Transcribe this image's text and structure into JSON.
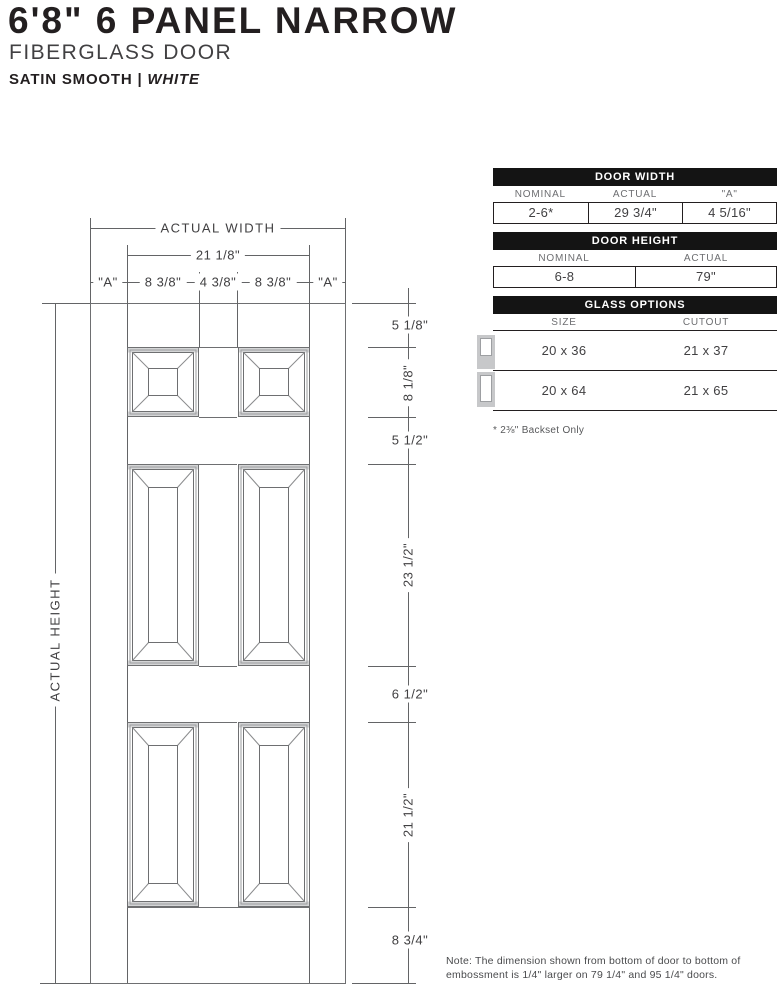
{
  "header": {
    "title": "6'8\" 6 PANEL NARROW",
    "subtitle": "FIBERGLASS DOOR",
    "finish": "SATIN SMOOTH",
    "separator": " | ",
    "color": "WHITE"
  },
  "diagram": {
    "labels": {
      "actual_width": "ACTUAL WIDTH",
      "actual_height": "ACTUAL HEIGHT",
      "inner_width": "21 1/8\"",
      "a_left": "\"A\"",
      "w_838_left": "8 3/8\"",
      "w_438": "4 3/8\"",
      "w_838_right": "8 3/8\"",
      "a_right": "\"A\"",
      "h_top_rail": "5 1/8\"",
      "h_top_panel": "8 1/8\"",
      "h_mid_rail1": "5 1/2\"",
      "h_mid_panel": "23 1/2\"",
      "h_mid_rail2": "6 1/2\"",
      "h_bottom_panel": "21 1/2\"",
      "h_bottom_rail": "8 3/4\""
    }
  },
  "tables": {
    "door_width": {
      "title": "DOOR WIDTH",
      "headers": [
        "NOMINAL",
        "ACTUAL",
        "\"A\""
      ],
      "values": [
        "2-6*",
        "29 3/4\"",
        "4 5/16\""
      ]
    },
    "door_height": {
      "title": "DOOR HEIGHT",
      "headers": [
        "NOMINAL",
        "ACTUAL"
      ],
      "values": [
        "6-8",
        "79\""
      ]
    },
    "glass_options": {
      "title": "GLASS OPTIONS",
      "headers": [
        "SIZE",
        "CUTOUT"
      ],
      "rows": [
        {
          "size": "20 x 36",
          "cutout": "21 x 37",
          "icon": "half-lite-door-icon"
        },
        {
          "size": "20 x 64",
          "cutout": "21 x 65",
          "icon": "full-lite-door-icon"
        }
      ],
      "footnote": "* 2⅜\" Backset Only"
    }
  },
  "note": "Note: The dimension shown from bottom of door to bottom of embossment is 1/4\" larger on 79 1/4\" and 95 1/4\" doors."
}
